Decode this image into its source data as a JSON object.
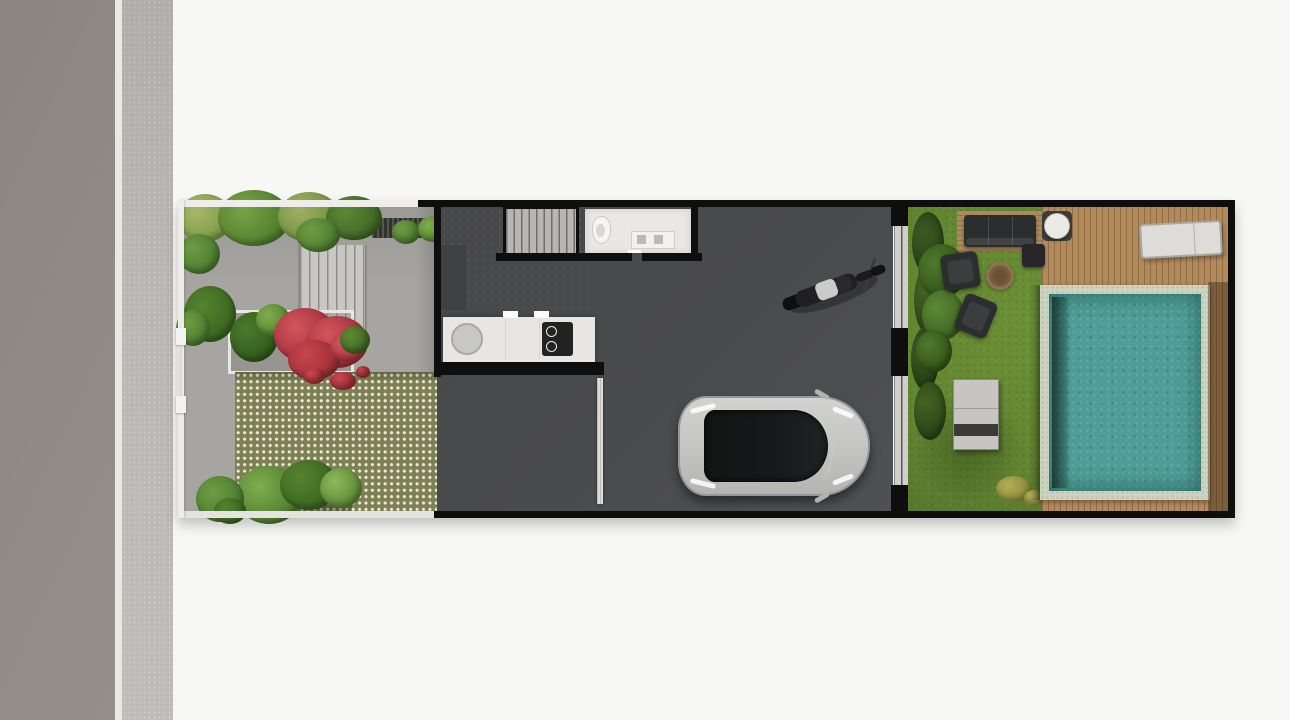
{
  "scene": {
    "type": "architectural-site-plan-top-view",
    "description": "Top-down rendered site plan of a long narrow house lot: street and sidewalk on the left, front garden with grass-block paving and red bougainvillea, dark-floored house with stairs, bathroom, kitchen, motorcycle and car carport, then a backyard lawn with outdoor furniture, wooden deck and swimming pool."
  },
  "palette": {
    "background": "#f7f7f5",
    "road": "#8a8580",
    "road_edge": "#eae8e4",
    "sidewalk": "#b9b7b3",
    "plot_wall": "#0e0e0e",
    "garden_fence": "#eeedea",
    "garden_paving": "#a6a5a1",
    "steps": "#c8c7c3",
    "step_line": "#8f8e8a",
    "grate": "#33332e",
    "checker_base": "#7d8054",
    "checker_dot": "#ece9d6",
    "driveway": "#91908c",
    "interior_floor": "#4a4b4d",
    "stairs": "#b7b6b3",
    "bathroom": "#e9e8e5",
    "counter": "#e7e6e3",
    "sink": "#c7c7c4",
    "cooktop": "#222222",
    "car_body": "#c6c6c4",
    "car_glass": "#17191a",
    "moto_body": "#202022",
    "moto_seat": "#cbcbc9",
    "glass_door": "#cfcfcc",
    "lawn": "#6b9136",
    "lawn_dark": "#50702a",
    "hedge": "#3c5a24",
    "foliage": "#6f9c44",
    "foliage_light": "#a9b86b",
    "foliage_dark": "#4e7a2c",
    "red_shrub": "#d4555e",
    "red_shrub_dark": "#9e2e38",
    "fern": "#7fae4f",
    "deck": "#b28b5d",
    "pool_coping": "#cdd3c0",
    "pool_water": "#4f9d96",
    "pool_step": "#2f4a3e",
    "sofa": "#2c2d2f",
    "platform": "#a98a5c",
    "firepit": "#7d6140",
    "bench": "#c6c5c1",
    "lounger": "#dddcd8",
    "table_white": "#eceae7",
    "flower_yellow": "#b1ad52"
  },
  "objects": {
    "road": {
      "label": "Street"
    },
    "sidewalk": {
      "label": "Sidewalk"
    },
    "plot": {
      "label": "House lot (top view)"
    },
    "front_garden": {
      "label": "Front garden with grass-block paving"
    },
    "entry_steps": {
      "label": "Entry steps"
    },
    "drain_grate": {
      "label": "Drainage grate"
    },
    "planter": {
      "label": "Planter with red bougainvillea"
    },
    "checker_paving": {
      "label": "Grass-block paver courtyard"
    },
    "gate": {
      "label": "Front gate"
    },
    "stairs": {
      "label": "Staircase"
    },
    "bathroom": {
      "label": "Bathroom"
    },
    "toilet": {
      "label": "Toilet"
    },
    "vanity": {
      "label": "Bathroom vanity"
    },
    "kitchen": {
      "label": "Kitchen counter"
    },
    "sink": {
      "label": "Kitchen sink"
    },
    "cooktop": {
      "label": "Cooktop"
    },
    "garage": {
      "label": "Garage / carport floor"
    },
    "driveway": {
      "label": "Driveway strip"
    },
    "garage_door": {
      "label": "Garage door"
    },
    "car": {
      "label": "Car (top view)"
    },
    "motorcycle": {
      "label": "Motorcycle"
    },
    "glass_door": {
      "label": "Sliding glass door to backyard"
    },
    "backyard": {
      "label": "Backyard lawn"
    },
    "hedge": {
      "label": "Hedge"
    },
    "sofa": {
      "label": "Outdoor sofa"
    },
    "side_table": {
      "label": "Side table"
    },
    "armchair_1": {
      "label": "Lounge chair"
    },
    "armchair_2": {
      "label": "Lounge chair"
    },
    "fire_pit": {
      "label": "Fire pit"
    },
    "garden_bench": {
      "label": "Garden table bench"
    },
    "round_table": {
      "label": "Round side table"
    },
    "sun_lounger": {
      "label": "Sun lounger"
    },
    "deck": {
      "label": "Wooden pool deck"
    },
    "pool": {
      "label": "Swimming pool"
    },
    "pool_step": {
      "label": "Pool bench step"
    }
  }
}
